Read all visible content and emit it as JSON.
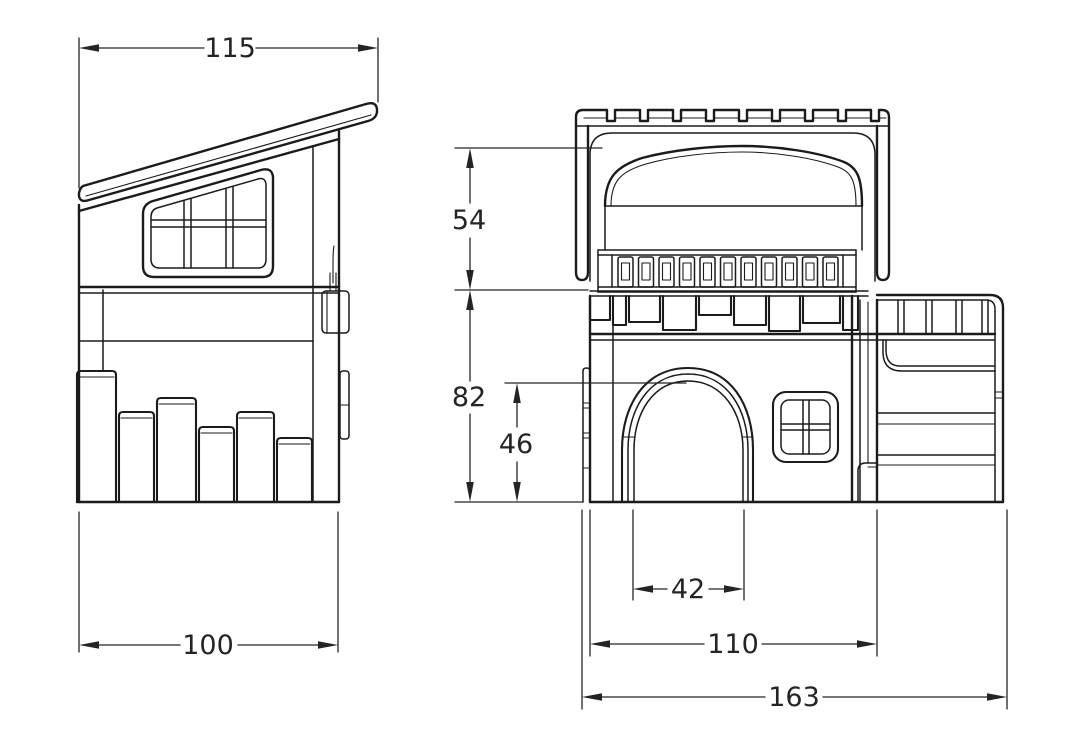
{
  "page": {
    "background_color": "#ffffff",
    "line_color": "#1b1b1b"
  },
  "drawing": {
    "type": "technical_drawing",
    "views": {
      "side_view": {
        "dimensions": {
          "top_width": "115",
          "base_width": "100"
        }
      },
      "front_view": {
        "dimensions": {
          "upper_height": "54",
          "lower_height": "82",
          "door_height": "46",
          "door_width": "42",
          "body_width": "110",
          "overall_width": "163"
        }
      }
    }
  }
}
